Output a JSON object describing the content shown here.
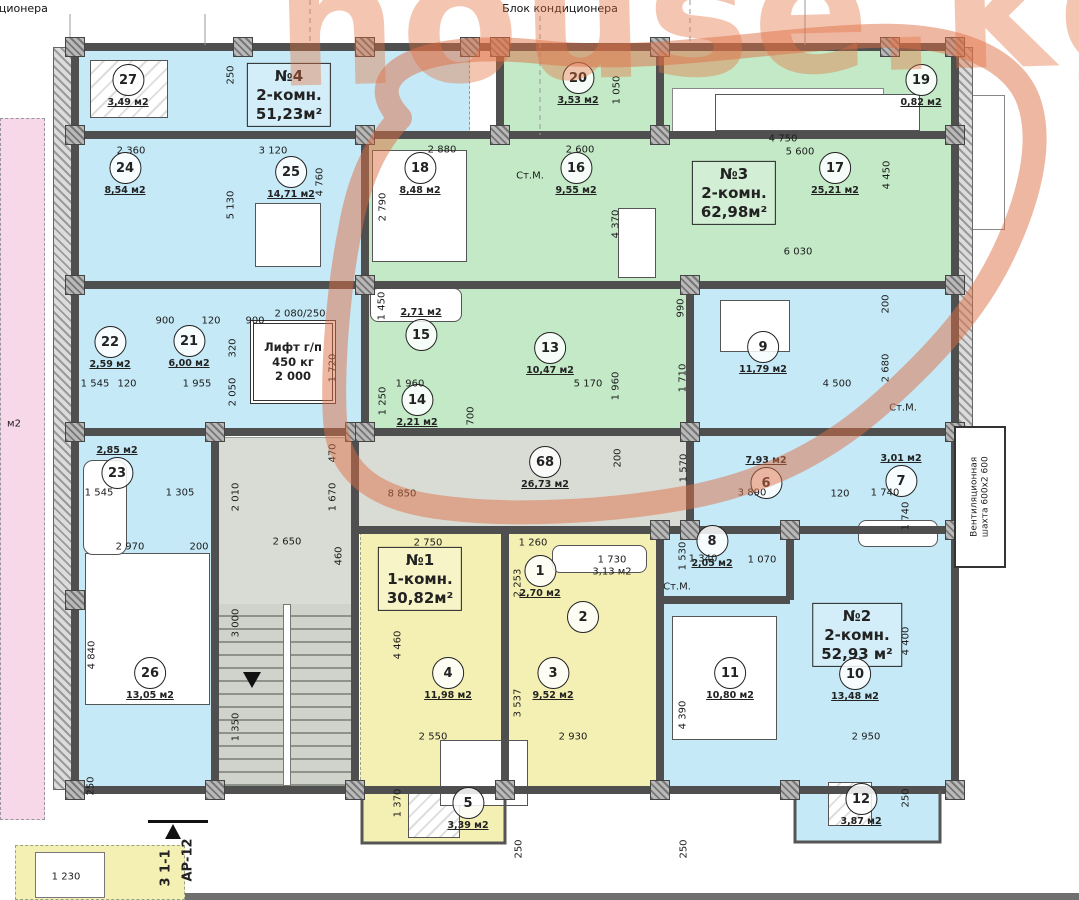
{
  "watermark": "house.kg",
  "top_labels": [
    {
      "text": "Блок кондиционера",
      "x": -10,
      "y": 2
    },
    {
      "text": "Блок кондиционера",
      "x": 560,
      "y": 2
    }
  ],
  "apartments": [
    {
      "name": "apt-4",
      "lines": [
        "№4",
        "2-комн.",
        "51,23м²"
      ],
      "x": 289,
      "y": 95
    },
    {
      "name": "apt-3",
      "lines": [
        "№3",
        "2-комн.",
        "62,98м²"
      ],
      "x": 734,
      "y": 193
    },
    {
      "name": "apt-1",
      "lines": [
        "№1",
        "1-комн.",
        "30,82м²"
      ],
      "x": 420,
      "y": 579
    },
    {
      "name": "apt-2",
      "lines": [
        "№2",
        "2-комн.",
        "52,93 м²"
      ],
      "x": 857,
      "y": 635
    }
  ],
  "rooms": [
    {
      "n": "27",
      "area": "3,49 м2",
      "x": 128,
      "y": 86
    },
    {
      "n": "24",
      "area": "8,54 м2",
      "x": 125,
      "y": 174
    },
    {
      "n": "25",
      "area": "14,71 м2",
      "x": 291,
      "y": 178
    },
    {
      "n": "22",
      "area": "2,59 м2",
      "x": 110,
      "y": 348
    },
    {
      "n": "21",
      "area": "6,00 м2",
      "x": 189,
      "y": 347
    },
    {
      "n": "23",
      "area": "2,85 м2",
      "x": 117,
      "y": 467,
      "ap": "above"
    },
    {
      "n": "26",
      "area": "13,05 м2",
      "x": 150,
      "y": 679
    },
    {
      "n": "20",
      "area": "3,53 м2",
      "x": 578,
      "y": 84
    },
    {
      "n": "18",
      "area": "8,48 м2",
      "x": 420,
      "y": 174
    },
    {
      "n": "16",
      "area": "9,55 м2",
      "x": 576,
      "y": 174
    },
    {
      "n": "15",
      "area": "2,71 м2",
      "x": 421,
      "y": 329,
      "ap": "above"
    },
    {
      "n": "14",
      "area": "2,21 м2",
      "x": 417,
      "y": 406
    },
    {
      "n": "13",
      "area": "10,47 м2",
      "x": 550,
      "y": 354
    },
    {
      "n": "17",
      "area": "25,21 м2",
      "x": 835,
      "y": 174
    },
    {
      "n": "19",
      "area": "0,82 м2",
      "x": 921,
      "y": 86
    },
    {
      "n": "9",
      "area": "11,79 м2",
      "x": 763,
      "y": 353
    },
    {
      "n": "6",
      "area": "7,93 м2",
      "x": 766,
      "y": 477,
      "ap": "above"
    },
    {
      "n": "7",
      "area": "3,01 м2",
      "x": 901,
      "y": 475,
      "ap": "above"
    },
    {
      "n": "68",
      "area": "26,73 м2",
      "x": 545,
      "y": 468
    },
    {
      "n": "1",
      "area": "2,70 м2",
      "x": 540,
      "y": 577
    },
    {
      "n": "2",
      "area": "",
      "x": 583,
      "y": 617
    },
    {
      "n": "4",
      "area": "11,98 м2",
      "x": 448,
      "y": 679
    },
    {
      "n": "3",
      "area": "9,52 м2",
      "x": 553,
      "y": 679
    },
    {
      "n": "5",
      "area": "3,39 м2",
      "x": 468,
      "y": 809
    },
    {
      "n": "8",
      "area": "2,05 м2",
      "x": 712,
      "y": 547
    },
    {
      "n": "11",
      "area": "10,80 м2",
      "x": 730,
      "y": 679
    },
    {
      "n": "10",
      "area": "13,48 м2",
      "x": 855,
      "y": 680
    },
    {
      "n": "12",
      "area": "3,87 м2",
      "x": 861,
      "y": 805
    }
  ],
  "dims": [
    {
      "t": "2 360",
      "x": 131,
      "y": 151
    },
    {
      "t": "3 120",
      "x": 273,
      "y": 151
    },
    {
      "t": "250",
      "x": 231,
      "y": 75,
      "r": -90
    },
    {
      "t": "5 130",
      "x": 231,
      "y": 205,
      "r": -90
    },
    {
      "t": "4 760",
      "x": 320,
      "y": 182,
      "r": -90
    },
    {
      "t": "2 880",
      "x": 442,
      "y": 150
    },
    {
      "t": "2 600",
      "x": 580,
      "y": 150
    },
    {
      "t": "1 050",
      "x": 617,
      "y": 90,
      "r": -90
    },
    {
      "t": "2 790",
      "x": 383,
      "y": 207,
      "r": -90
    },
    {
      "t": "4 370",
      "x": 616,
      "y": 224,
      "r": -90
    },
    {
      "t": "4 750",
      "x": 783,
      "y": 139
    },
    {
      "t": "5 600",
      "x": 800,
      "y": 152
    },
    {
      "t": "4 450",
      "x": 887,
      "y": 175,
      "r": -90
    },
    {
      "t": "6 030",
      "x": 798,
      "y": 252
    },
    {
      "t": "900",
      "x": 165,
      "y": 321
    },
    {
      "t": "120",
      "x": 211,
      "y": 321
    },
    {
      "t": "900",
      "x": 255,
      "y": 321
    },
    {
      "t": "320",
      "x": 233,
      "y": 348,
      "r": -90
    },
    {
      "t": "2 050",
      "x": 233,
      "y": 392,
      "r": -90
    },
    {
      "t": "1 545",
      "x": 95,
      "y": 384
    },
    {
      "t": "120",
      "x": 127,
      "y": 384
    },
    {
      "t": "1 955",
      "x": 197,
      "y": 384
    },
    {
      "t": "2 080/250",
      "x": 300,
      "y": 314
    },
    {
      "t": "1 720",
      "x": 333,
      "y": 368,
      "r": -90
    },
    {
      "t": "470",
      "x": 333,
      "y": 453,
      "r": -90
    },
    {
      "t": "1 670",
      "x": 333,
      "y": 497,
      "r": -90
    },
    {
      "t": "1 450",
      "x": 382,
      "y": 306,
      "r": -90
    },
    {
      "t": "1 960",
      "x": 410,
      "y": 384
    },
    {
      "t": "1 250",
      "x": 383,
      "y": 401,
      "r": -90
    },
    {
      "t": "700",
      "x": 471,
      "y": 416,
      "r": -90
    },
    {
      "t": "5 170",
      "x": 588,
      "y": 384
    },
    {
      "t": "1 960",
      "x": 616,
      "y": 386,
      "r": -90
    },
    {
      "t": "990",
      "x": 681,
      "y": 308,
      "r": -90
    },
    {
      "t": "1 710",
      "x": 683,
      "y": 378,
      "r": -90
    },
    {
      "t": "4 500",
      "x": 837,
      "y": 384
    },
    {
      "t": "2 680",
      "x": 886,
      "y": 368,
      "r": -90
    },
    {
      "t": "200",
      "x": 886,
      "y": 304,
      "r": -90
    },
    {
      "t": "3 890",
      "x": 752,
      "y": 493
    },
    {
      "t": "120",
      "x": 840,
      "y": 494
    },
    {
      "t": "1 740",
      "x": 885,
      "y": 493
    },
    {
      "t": "8 850",
      "x": 402,
      "y": 494
    },
    {
      "t": "200",
      "x": 618,
      "y": 458,
      "r": -90
    },
    {
      "t": "1 570",
      "x": 684,
      "y": 468,
      "r": -90
    },
    {
      "t": "460",
      "x": 339,
      "y": 556,
      "r": -90
    },
    {
      "t": "2 750",
      "x": 428,
      "y": 543
    },
    {
      "t": "1 260",
      "x": 533,
      "y": 543
    },
    {
      "t": "2 253",
      "x": 518,
      "y": 583,
      "r": -90
    },
    {
      "t": "1 730",
      "x": 612,
      "y": 560
    },
    {
      "t": "3,13 м2",
      "x": 612,
      "y": 572
    },
    {
      "t": "1 530",
      "x": 683,
      "y": 556,
      "r": -90
    },
    {
      "t": "1 340",
      "x": 703,
      "y": 559
    },
    {
      "t": "1 070",
      "x": 762,
      "y": 560
    },
    {
      "t": "2 010",
      "x": 236,
      "y": 497,
      "r": -90
    },
    {
      "t": "1 305",
      "x": 180,
      "y": 493
    },
    {
      "t": "1 545",
      "x": 99,
      "y": 493
    },
    {
      "t": "2 970",
      "x": 130,
      "y": 547
    },
    {
      "t": "200",
      "x": 199,
      "y": 547
    },
    {
      "t": "2 650",
      "x": 287,
      "y": 542
    },
    {
      "t": "3 000",
      "x": 236,
      "y": 623,
      "r": -90
    },
    {
      "t": "1 350",
      "x": 236,
      "y": 727,
      "r": -90
    },
    {
      "t": "250",
      "x": 91,
      "y": 786,
      "r": -90
    },
    {
      "t": "1 230",
      "x": 66,
      "y": 877
    },
    {
      "t": "4 840",
      "x": 92,
      "y": 655,
      "r": -90
    },
    {
      "t": "4 460",
      "x": 398,
      "y": 645,
      "r": -90
    },
    {
      "t": "2 550",
      "x": 433,
      "y": 737
    },
    {
      "t": "2 930",
      "x": 573,
      "y": 737
    },
    {
      "t": "3 537",
      "x": 518,
      "y": 703,
      "r": -90
    },
    {
      "t": "1 370",
      "x": 398,
      "y": 803,
      "r": -90
    },
    {
      "t": "250",
      "x": 519,
      "y": 849,
      "r": -90
    },
    {
      "t": "250",
      "x": 684,
      "y": 849,
      "r": -90
    },
    {
      "t": "2 950",
      "x": 866,
      "y": 737
    },
    {
      "t": "4 390",
      "x": 683,
      "y": 715,
      "r": -90
    },
    {
      "t": "1 740",
      "x": 906,
      "y": 516,
      "r": -90
    },
    {
      "t": "4 400",
      "x": 906,
      "y": 641,
      "r": -90
    },
    {
      "t": "250",
      "x": 906,
      "y": 798,
      "r": -90
    },
    {
      "t": "Ст.М.",
      "x": 530,
      "y": 176
    },
    {
      "t": "Ст.М.",
      "x": 677,
      "y": 587
    },
    {
      "t": "Ст.М.",
      "x": 903,
      "y": 408
    },
    {
      "t": "м2",
      "x": 14,
      "y": 424
    }
  ],
  "elevator": {
    "line1": "Лифт г/п",
    "line2": "450 кг",
    "line3": "2 000"
  },
  "vent": {
    "line1": "Вентиляционная",
    "line2": "шахта 600х2 600"
  },
  "section_mark": {
    "label1": "3 1-1",
    "label2": "АР-12"
  },
  "colors": {
    "blue": "#c5e9f6",
    "green": "#c3e9c6",
    "yellow": "#f4f0b4",
    "pink": "#f6d8e9",
    "corridor_gray": "#d9dcd5",
    "wall": "#4f4f4f",
    "highlight_orange": "#dd6f45",
    "watermark_orange": "#e4723f"
  }
}
